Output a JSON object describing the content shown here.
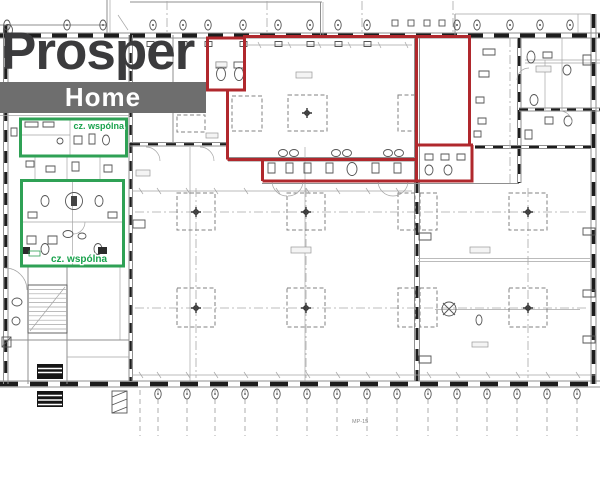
{
  "logo": {
    "brand_top": "Prosper",
    "brand_bottom": "Home"
  },
  "annotations": {
    "common_area_label_top": "cz. wspólna",
    "common_area_label_bottom": "cz. wspólna",
    "plan_code": "MP-15"
  },
  "colors": {
    "red_unit_outline": "#b0282d",
    "green_common_outline": "#2fa155",
    "green_label_text": "#18a24c",
    "logo_banner_gray": "#6e6e6e",
    "logo_text_gray": "#3b3b3d",
    "drawing_line_gray": "#8f8f8f"
  }
}
